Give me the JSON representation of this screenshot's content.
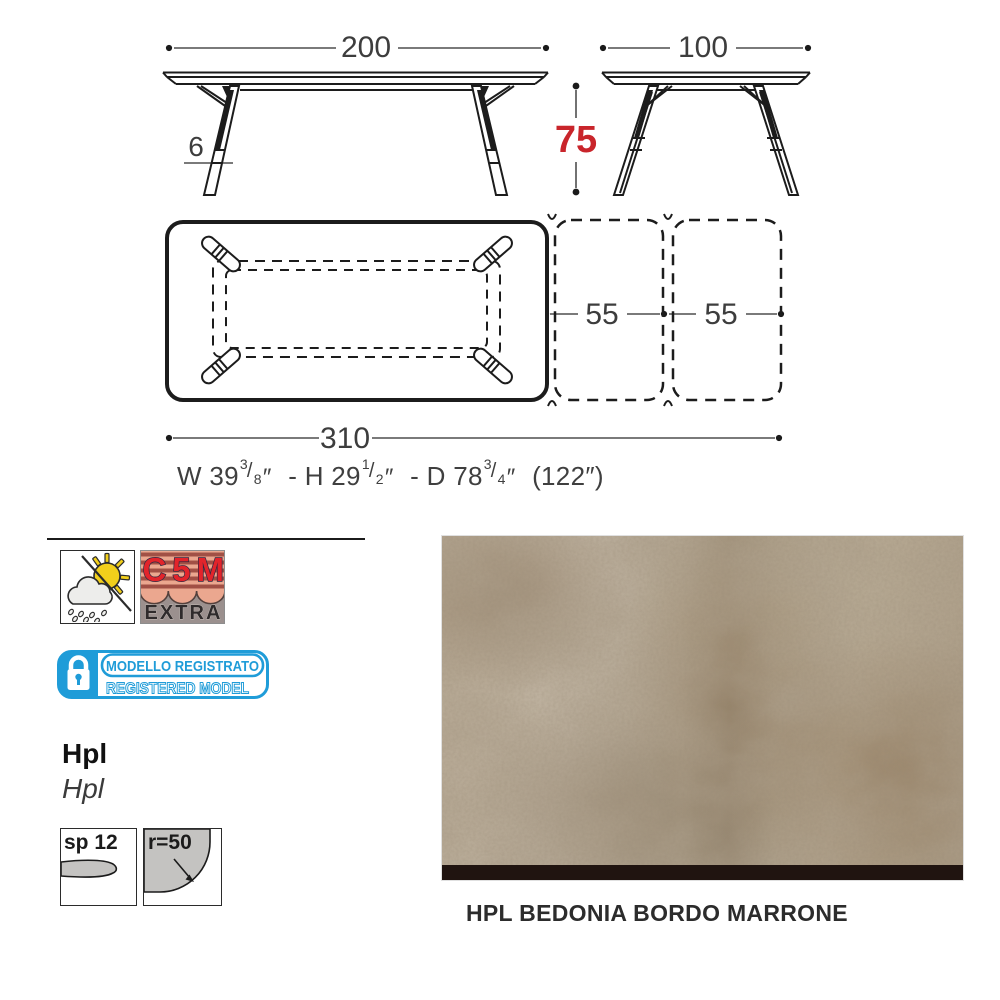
{
  "drawing": {
    "width_front": "200",
    "depth_side": "100",
    "height": "75",
    "leg_thickness": "6",
    "extension_left": "55",
    "extension_right": "55",
    "total_length": "310",
    "imperial": {
      "w_prefix": "W 39",
      "w_num": "3",
      "w_den": "8",
      "h_prefix": "- H 29",
      "h_num": "1",
      "h_den": "2",
      "d_prefix": "- D 78",
      "d_num": "3",
      "d_den": "4",
      "slash": "/",
      "inch": "″",
      "total_inches": "(122″)"
    }
  },
  "certifications": {
    "weather_icon": "sun-cloud-rain-icon",
    "corrosion_class": "C5M",
    "corrosion_class_sub": "EXTRA",
    "registered_model_it": "MODELLO REGISTRATO",
    "registered_model_en": "REGISTERED MODEL"
  },
  "material": {
    "name": "Hpl",
    "name_secondary": "Hpl",
    "thickness": "sp 12",
    "corner_radius": "r=50",
    "finish_caption": "HPL BEDONIA BORDO MARRONE"
  },
  "colors": {
    "accent_red": "#c9252b",
    "badge_blue": "#1f9cd8",
    "line_color": "#1c1c1c",
    "swatch_base": "#b1a290",
    "swatch_edge_brown": "#201410"
  }
}
